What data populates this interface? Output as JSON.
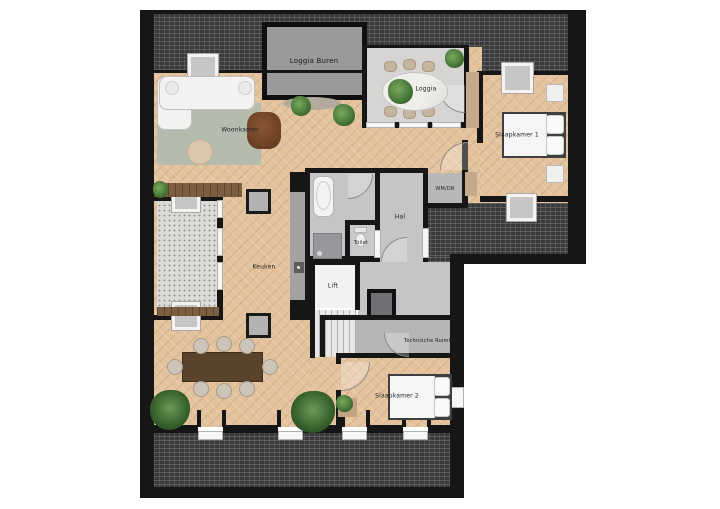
{
  "rooms": {
    "loggia_buren": "Loggia Buren",
    "loggia": "Loggia",
    "woonkamer": "Woonkamer",
    "slaapkamer1": "Slaapkamer 1",
    "wmdr": "WM/DR",
    "hal": "Hal",
    "toilet": "Toilet",
    "keuken": "Keuken",
    "lift": "Lift",
    "technische_ruimte": "Technische Ruimte",
    "slaapkamer2": "Slaapkamer 2"
  },
  "colors": {
    "wood_floor": "#e3c29c",
    "roof_hatch": "#3a3a3c",
    "wall": "#161616",
    "room_gray": "#c6c5c3",
    "table_wood": "#5a432c",
    "plant_green": "#4a7a3a"
  }
}
